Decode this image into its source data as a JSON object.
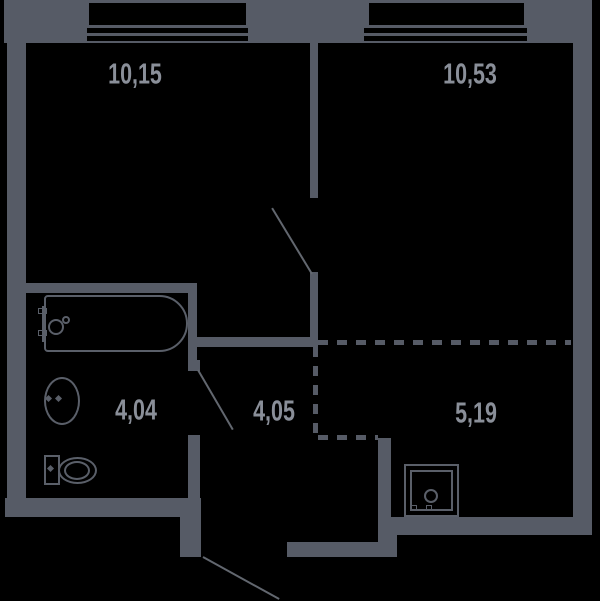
{
  "plan": {
    "kind": "apartment-floor-plan",
    "background_color": "#000000",
    "wall_color": "#565b66",
    "label_color": "#8a8f99"
  },
  "rooms": [
    {
      "id": "room-top-left",
      "area_label": "10,15"
    },
    {
      "id": "room-top-right",
      "area_label": "10,53"
    },
    {
      "id": "bathroom",
      "area_label": "4,04"
    },
    {
      "id": "hallway",
      "area_label": "4,05"
    },
    {
      "id": "kitchen-zone",
      "area_label": "5,19"
    }
  ],
  "fixtures": [
    {
      "id": "bathtub"
    },
    {
      "id": "washbasin"
    },
    {
      "id": "toilet"
    },
    {
      "id": "kitchen-sink"
    }
  ],
  "windows": [
    {
      "id": "window-top-left"
    },
    {
      "id": "window-top-right"
    }
  ]
}
